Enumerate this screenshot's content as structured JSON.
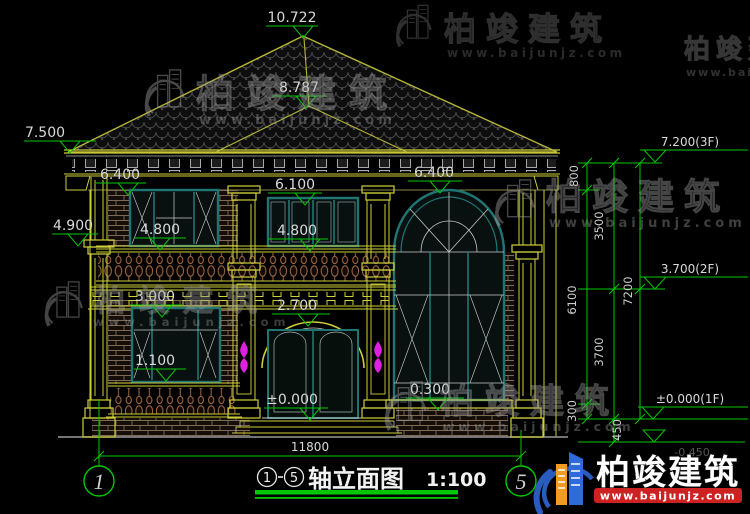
{
  "drawing": {
    "type": "elevation",
    "background": "#000000",
    "line_colors": {
      "trim": "#cfcf3a",
      "roof": "#b5b535",
      "frame": "#217474",
      "dims": "#00c800",
      "text": "#d9d9d9",
      "ornament": "#e020e0"
    }
  },
  "markers": {
    "ridge": "10.722",
    "upper_ridge": "8.787",
    "left_eave": "7.500",
    "left_soffit": "6.400",
    "left_capital": "4.900",
    "window2f_top": "6.100",
    "left_sill_2f": "4.800",
    "center_sill_2f": "4.800",
    "arch_top": "6.400",
    "balcony_rail": "3.000",
    "door_arch": "2.700",
    "sill_1f": "1.100",
    "floor_zero": "±0.000",
    "porch": "0.300"
  },
  "floor_levels": {
    "f3": "7.200(3F)",
    "f2": "3.700(2F)",
    "f1": "±0.000(1F)",
    "ground": "-0.450"
  },
  "vertical_dims": {
    "d800": "800",
    "d3500": "3500",
    "d6100": "6100",
    "d3700": "3700",
    "d7200": "7200",
    "d300": "300",
    "d450": "450"
  },
  "bottom": {
    "total_width": "11800",
    "axis_left": "1",
    "axis_right": "5"
  },
  "title_block": {
    "axis_from": "1",
    "axis_to": "5",
    "name": "轴立面图",
    "scale": "1:100"
  },
  "watermark": {
    "brand": "柏竣建筑",
    "site": "www.baijunjz.com"
  },
  "brand_logo": {
    "name": "柏竣建筑",
    "site": "www.baijunjz.com"
  }
}
